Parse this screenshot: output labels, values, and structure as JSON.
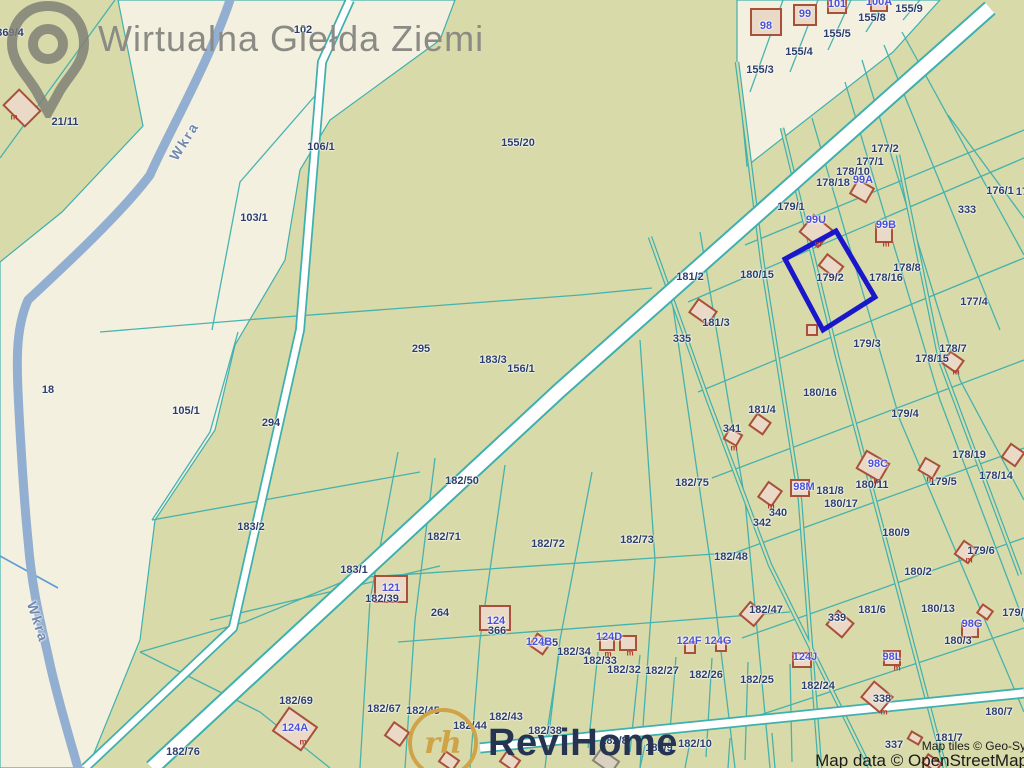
{
  "watermark": {
    "brand": "Wirtualna Giełda Ziemi"
  },
  "logo": {
    "brand": "ReviHome",
    "monogram": "rh"
  },
  "attribution": {
    "line1": "Map tiles © Geo-Sy",
    "line2": "Map data © OpenStreetMap"
  },
  "colors": {
    "parcel_olive": "#d8daa9",
    "corridor_cream": "#f3f0df",
    "boundary_teal": "#3fb0ae",
    "river_blue": "#92aed0",
    "road_white": "#ffffff",
    "highlight_blue": "#1a16c9",
    "building_stroke": "#a8503a",
    "building_fill": "#ead9c7",
    "parcel_label_navy": "#2c3e6b",
    "building_label_blue": "#4a50d8"
  },
  "map": {
    "river_name": "Wkra",
    "highlighted_parcel": "179/2",
    "river_labels": [
      {
        "text": "Wkra",
        "x": 184,
        "y": 141,
        "rot": -58
      },
      {
        "text": "Wkra",
        "x": 38,
        "y": 622,
        "rot": 72
      }
    ],
    "parcel_labels": [
      {
        "id": "369/4",
        "x": 10,
        "y": 33
      },
      {
        "id": "21/11",
        "x": 65,
        "y": 122
      },
      {
        "id": "102",
        "x": 303,
        "y": 30
      },
      {
        "id": "106/1",
        "x": 321,
        "y": 147
      },
      {
        "id": "103/1",
        "x": 254,
        "y": 218
      },
      {
        "id": "155/20",
        "x": 518,
        "y": 143
      },
      {
        "id": "155/3",
        "x": 760,
        "y": 70
      },
      {
        "id": "155/4",
        "x": 799,
        "y": 52
      },
      {
        "id": "155/5",
        "x": 837,
        "y": 34
      },
      {
        "id": "155/8",
        "x": 872,
        "y": 18
      },
      {
        "id": "155/9",
        "x": 909,
        "y": 9
      },
      {
        "id": "177/2",
        "x": 885,
        "y": 149
      },
      {
        "id": "177/1",
        "x": 870,
        "y": 162
      },
      {
        "id": "178/10",
        "x": 853,
        "y": 172
      },
      {
        "id": "178/18",
        "x": 833,
        "y": 183
      },
      {
        "id": "176/1",
        "x": 1000,
        "y": 191
      },
      {
        "id": "17",
        "x": 1022,
        "y": 192
      },
      {
        "id": "333",
        "x": 967,
        "y": 210
      },
      {
        "id": "179/1",
        "x": 791,
        "y": 207
      },
      {
        "id": "181/2",
        "x": 690,
        "y": 277
      },
      {
        "id": "180/15",
        "x": 757,
        "y": 275
      },
      {
        "id": "179/2",
        "x": 830,
        "y": 278
      },
      {
        "id": "178/8",
        "x": 907,
        "y": 268
      },
      {
        "id": "178/16",
        "x": 886,
        "y": 278
      },
      {
        "id": "177/4",
        "x": 974,
        "y": 302
      },
      {
        "id": "181/3",
        "x": 716,
        "y": 323
      },
      {
        "id": "335",
        "x": 682,
        "y": 339
      },
      {
        "id": "179/3",
        "x": 867,
        "y": 344
      },
      {
        "id": "178/7",
        "x": 953,
        "y": 349
      },
      {
        "id": "178/15",
        "x": 932,
        "y": 359
      },
      {
        "id": "18",
        "x": 48,
        "y": 390
      },
      {
        "id": "295",
        "x": 421,
        "y": 349
      },
      {
        "id": "183/3",
        "x": 493,
        "y": 360
      },
      {
        "id": "156/1",
        "x": 521,
        "y": 369
      },
      {
        "id": "105/1",
        "x": 186,
        "y": 411
      },
      {
        "id": "294",
        "x": 271,
        "y": 423
      },
      {
        "id": "180/16",
        "x": 820,
        "y": 393
      },
      {
        "id": "179/4",
        "x": 905,
        "y": 414
      },
      {
        "id": "181/4",
        "x": 762,
        "y": 410
      },
      {
        "id": "341",
        "x": 732,
        "y": 429
      },
      {
        "id": "178/19",
        "x": 969,
        "y": 455
      },
      {
        "id": "178/14",
        "x": 996,
        "y": 476
      },
      {
        "id": "179/5",
        "x": 943,
        "y": 482
      },
      {
        "id": "180/11",
        "x": 872,
        "y": 485
      },
      {
        "id": "182/50",
        "x": 462,
        "y": 481
      },
      {
        "id": "182/75",
        "x": 692,
        "y": 483
      },
      {
        "id": "181/8",
        "x": 830,
        "y": 491
      },
      {
        "id": "180/17",
        "x": 841,
        "y": 504
      },
      {
        "id": "340",
        "x": 778,
        "y": 513
      },
      {
        "id": "342",
        "x": 762,
        "y": 523
      },
      {
        "id": "180/9",
        "x": 896,
        "y": 533
      },
      {
        "id": "182/71",
        "x": 444,
        "y": 537
      },
      {
        "id": "182/72",
        "x": 548,
        "y": 544
      },
      {
        "id": "182/73",
        "x": 637,
        "y": 540
      },
      {
        "id": "182/48",
        "x": 731,
        "y": 557
      },
      {
        "id": "183/2",
        "x": 251,
        "y": 527
      },
      {
        "id": "183/1",
        "x": 354,
        "y": 570
      },
      {
        "id": "182/39",
        "x": 382,
        "y": 599
      },
      {
        "id": "179/6",
        "x": 981,
        "y": 551
      },
      {
        "id": "180/2",
        "x": 918,
        "y": 572
      },
      {
        "id": "264",
        "x": 440,
        "y": 613
      },
      {
        "id": "366",
        "x": 497,
        "y": 631
      },
      {
        "id": "365",
        "x": 549,
        "y": 643
      },
      {
        "id": "182/47",
        "x": 766,
        "y": 610
      },
      {
        "id": "339",
        "x": 837,
        "y": 618
      },
      {
        "id": "181/6",
        "x": 872,
        "y": 610
      },
      {
        "id": "180/13",
        "x": 938,
        "y": 609
      },
      {
        "id": "179/1",
        "x": 1016,
        "y": 613
      },
      {
        "id": "180/3",
        "x": 958,
        "y": 641
      },
      {
        "id": "182/25",
        "x": 757,
        "y": 680
      },
      {
        "id": "182/24",
        "x": 818,
        "y": 686
      },
      {
        "id": "182/26",
        "x": 706,
        "y": 675
      },
      {
        "id": "182/27",
        "x": 662,
        "y": 671
      },
      {
        "id": "182/32",
        "x": 624,
        "y": 670
      },
      {
        "id": "182/33",
        "x": 600,
        "y": 661
      },
      {
        "id": "182/34",
        "x": 574,
        "y": 652
      },
      {
        "id": "182/45",
        "x": 423,
        "y": 711
      },
      {
        "id": "182/67",
        "x": 384,
        "y": 709
      },
      {
        "id": "182/69",
        "x": 296,
        "y": 701
      },
      {
        "id": "182/76",
        "x": 183,
        "y": 752
      },
      {
        "id": "182/44",
        "x": 470,
        "y": 726
      },
      {
        "id": "182/43",
        "x": 506,
        "y": 717
      },
      {
        "id": "182/38",
        "x": 545,
        "y": 731
      },
      {
        "id": "182/8",
        "x": 614,
        "y": 741
      },
      {
        "id": "182/9",
        "x": 659,
        "y": 748
      },
      {
        "id": "182/10",
        "x": 695,
        "y": 744
      },
      {
        "id": "337",
        "x": 894,
        "y": 745
      },
      {
        "id": "181/7",
        "x": 949,
        "y": 738
      },
      {
        "id": "338",
        "x": 882,
        "y": 699
      },
      {
        "id": "180/7",
        "x": 999,
        "y": 712
      }
    ],
    "building_labels": [
      {
        "id": "98",
        "x": 766,
        "y": 26
      },
      {
        "id": "99",
        "x": 805,
        "y": 14
      },
      {
        "id": "101",
        "x": 837,
        "y": 4
      },
      {
        "id": "100A",
        "x": 879,
        "y": 2
      },
      {
        "id": "99A",
        "x": 863,
        "y": 180
      },
      {
        "id": "99U",
        "x": 816,
        "y": 220
      },
      {
        "id": "99B",
        "x": 886,
        "y": 225
      },
      {
        "id": "98C",
        "x": 878,
        "y": 464
      },
      {
        "id": "98M",
        "x": 804,
        "y": 487
      },
      {
        "id": "98G",
        "x": 972,
        "y": 624
      },
      {
        "id": "98L",
        "x": 892,
        "y": 657
      },
      {
        "id": "121",
        "x": 391,
        "y": 588
      },
      {
        "id": "124",
        "x": 496,
        "y": 621
      },
      {
        "id": "124B",
        "x": 539,
        "y": 642
      },
      {
        "id": "124A",
        "x": 295,
        "y": 728
      },
      {
        "id": "124D",
        "x": 609,
        "y": 637
      },
      {
        "id": "124F",
        "x": 689,
        "y": 641
      },
      {
        "id": "124G",
        "x": 718,
        "y": 641
      },
      {
        "id": "124J",
        "x": 805,
        "y": 657
      }
    ],
    "m_marks": [
      {
        "id": "m",
        "x": 14,
        "y": 117
      },
      {
        "id": "m",
        "x": 818,
        "y": 244
      },
      {
        "id": "m",
        "x": 886,
        "y": 244
      },
      {
        "id": "m",
        "x": 734,
        "y": 448
      },
      {
        "id": "m",
        "x": 930,
        "y": 479
      },
      {
        "id": "m",
        "x": 956,
        "y": 372
      },
      {
        "id": "m",
        "x": 608,
        "y": 654
      },
      {
        "id": "m",
        "x": 630,
        "y": 653
      },
      {
        "id": "m",
        "x": 303,
        "y": 742
      },
      {
        "id": "m",
        "x": 877,
        "y": 481
      },
      {
        "id": "m",
        "x": 969,
        "y": 560
      },
      {
        "id": "m",
        "x": 771,
        "y": 506
      },
      {
        "id": "m",
        "x": 897,
        "y": 668
      },
      {
        "id": "m",
        "x": 884,
        "y": 712
      }
    ],
    "buildings": [
      [
        22,
        108,
        30,
        22,
        45
      ],
      [
        766,
        22,
        30,
        26,
        0
      ],
      [
        805,
        15,
        22,
        20,
        0
      ],
      [
        837,
        6,
        18,
        14,
        0
      ],
      [
        879,
        5,
        16,
        12,
        0
      ],
      [
        862,
        191,
        18,
        16,
        30
      ],
      [
        816,
        231,
        24,
        22,
        40
      ],
      [
        884,
        233,
        16,
        18,
        0
      ],
      [
        831,
        266,
        20,
        14,
        38
      ],
      [
        703,
        312,
        22,
        16,
        35
      ],
      [
        812,
        330,
        10,
        10,
        0
      ],
      [
        733,
        437,
        14,
        12,
        30
      ],
      [
        760,
        424,
        16,
        14,
        35
      ],
      [
        770,
        494,
        16,
        18,
        35
      ],
      [
        800,
        488,
        18,
        16,
        0
      ],
      [
        873,
        466,
        26,
        20,
        30
      ],
      [
        953,
        362,
        16,
        14,
        35
      ],
      [
        929,
        468,
        16,
        14,
        30
      ],
      [
        1013,
        455,
        16,
        16,
        35
      ],
      [
        966,
        552,
        16,
        16,
        35
      ],
      [
        391,
        589,
        32,
        26,
        0
      ],
      [
        495,
        618,
        30,
        24,
        0
      ],
      [
        540,
        644,
        16,
        14,
        35
      ],
      [
        295,
        729,
        34,
        28,
        35
      ],
      [
        607,
        644,
        14,
        12,
        0
      ],
      [
        628,
        643,
        16,
        14,
        0
      ],
      [
        690,
        648,
        10,
        10,
        0
      ],
      [
        721,
        646,
        10,
        10,
        0
      ],
      [
        802,
        660,
        18,
        14,
        0
      ],
      [
        752,
        614,
        18,
        16,
        40
      ],
      [
        840,
        624,
        20,
        18,
        40
      ],
      [
        970,
        630,
        16,
        14,
        0
      ],
      [
        985,
        612,
        12,
        10,
        35
      ],
      [
        892,
        658,
        16,
        14,
        0
      ],
      [
        877,
        697,
        24,
        20,
        40
      ],
      [
        915,
        738,
        12,
        8,
        30
      ],
      [
        932,
        763,
        16,
        10,
        35
      ],
      [
        397,
        734,
        18,
        16,
        35
      ],
      [
        449,
        761,
        16,
        12,
        35
      ],
      [
        510,
        761,
        16,
        12,
        35
      ],
      [
        606,
        761,
        22,
        14,
        35,
        "gray"
      ]
    ],
    "highlight_polygon": "785,259 836,231 875,297 823,330"
  }
}
